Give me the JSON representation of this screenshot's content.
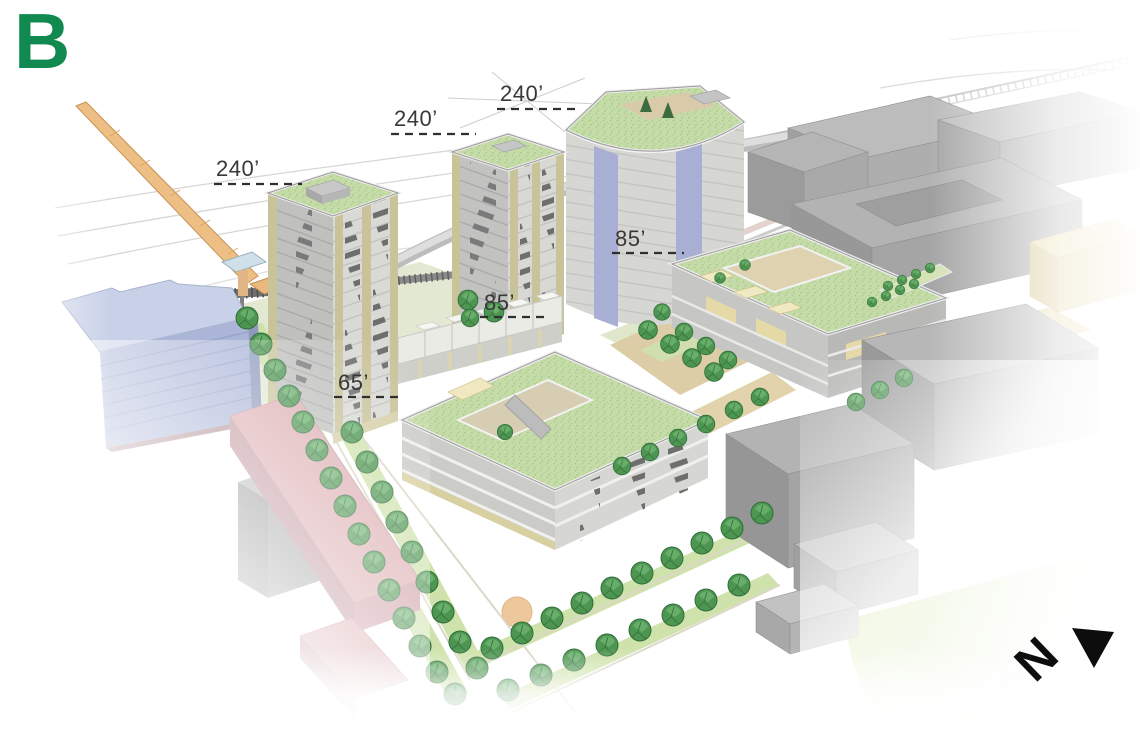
{
  "figure": {
    "label": "B"
  },
  "annotations": {
    "heights": [
      {
        "target": "tower-west",
        "label": "240’"
      },
      {
        "target": "tower-center",
        "label": "240’"
      },
      {
        "target": "tower-east",
        "label": "240’"
      },
      {
        "target": "midrise-east",
        "label": "85’"
      },
      {
        "target": "midrise-central",
        "label": "85’"
      },
      {
        "target": "midrise-south",
        "label": "65’"
      }
    ]
  },
  "compass": {
    "letter": "N"
  },
  "palette": {
    "figure_label_green": "#11894f",
    "annotation_text": "#383838",
    "compass_black": "#0d0d0d",
    "green_roof": "#c6dca8",
    "tree_green": "#4e9552",
    "facade_accent_olive": "#c9c39a",
    "glass_blue": "#a9afd4",
    "context_gray": "#b3b3b3",
    "residential_pink": "#dcaeb1",
    "office_blue": "#aab5d8",
    "crane_orange": "#eebf84",
    "lawn_green": "#c4e08b",
    "path_tan": "#dfd0a8"
  }
}
